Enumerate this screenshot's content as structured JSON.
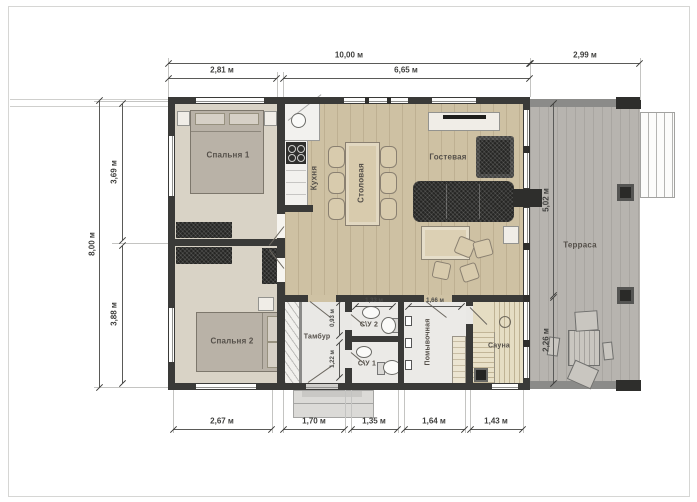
{
  "palette": {
    "wall": "#3a3a38",
    "wood": "#cec1a3",
    "bedroom": "#d9d3c6",
    "terrace": "#b7b4af",
    "bath": "#ebeae7",
    "sauna": "#e5ddc3",
    "dimline": "#5a5a58"
  },
  "rooms": {
    "bedroom1": "Спальня 1",
    "bedroom2": "Спальня 2",
    "kitchen": "Кухня",
    "dining": "Столовая",
    "living": "Гостевая",
    "terrace": "Терраса",
    "vestibule": "Тамбур",
    "wc2": "С\\У 2",
    "wc1": "С\\У 1",
    "washroom": "Помывочная",
    "sauna": "Сауна"
  },
  "dims": {
    "top_total": "10,00 м",
    "top_terrace": "2,99 м",
    "top_bedroom": "2,81 м",
    "top_living": "6,65 м",
    "left_total": "8,00 м",
    "left_top": "3,69 м",
    "left_bottom": "3,88 м",
    "terrace_height": "5,02 м",
    "terrace_lower": "2,26 м",
    "bottom": [
      "2,67 м",
      "1,70 м",
      "1,35 м",
      "1,64 м",
      "1,43 м"
    ],
    "wc2_width": "1,33 м",
    "washroom_width": "1,66 м",
    "wc2_depth": "0,93 м",
    "wc1_depth": "1,22 м"
  }
}
